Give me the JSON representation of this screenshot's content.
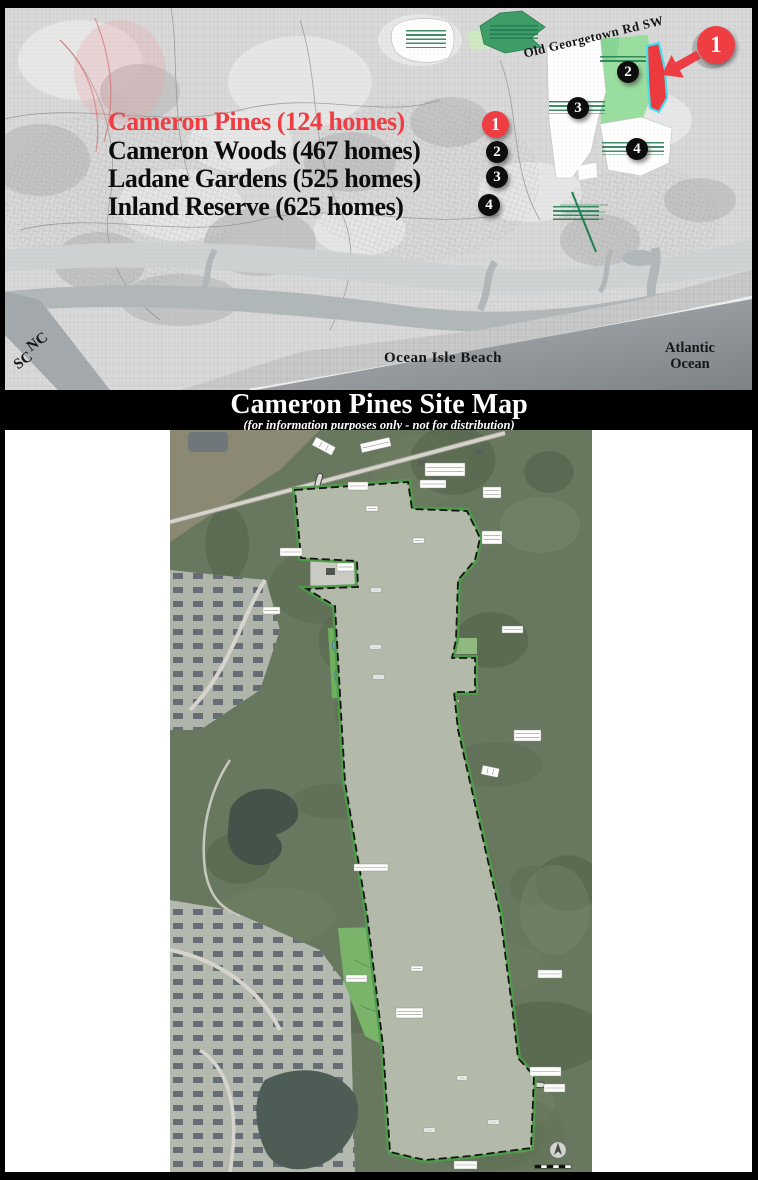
{
  "title_band": {
    "title": "Cameron Pines Site Map",
    "subtitle": "(for information purposes only - not for distribution)",
    "background": "#000000",
    "text_color": "#ffffff"
  },
  "legend": {
    "items": [
      {
        "label": "Cameron Pines (124 homes)",
        "marker": "1",
        "text_color": "#ee3e44",
        "marker_color": "#ee3e44"
      },
      {
        "label": "Cameron Woods (467 homes)",
        "marker": "2",
        "text_color": "#0d0d0d",
        "marker_color": "#0d0d0d"
      },
      {
        "label": "Ladane Gardens (525 homes)",
        "marker": "3",
        "text_color": "#0d0d0d",
        "marker_color": "#0d0d0d"
      },
      {
        "label": "Inland Reserve (625 homes)",
        "marker": "4",
        "text_color": "#0d0d0d",
        "marker_color": "#0d0d0d"
      }
    ]
  },
  "overview_map": {
    "road_label": "Old Georgetown Rd SW",
    "state_line": {
      "north": "NC",
      "south": "SC"
    },
    "beach_label": "Ocean Isle Beach",
    "ocean_label": "Atlantic Ocean",
    "markers": [
      {
        "number": "1",
        "highlighted": true
      },
      {
        "number": "2",
        "highlighted": false
      },
      {
        "number": "3",
        "highlighted": false
      },
      {
        "number": "4",
        "highlighted": false
      }
    ],
    "highlight": {
      "parcel_fill": "#ee3a3e",
      "parcel_outline": "#49dff0",
      "arrow_color": "#ee3e44"
    }
  }
}
